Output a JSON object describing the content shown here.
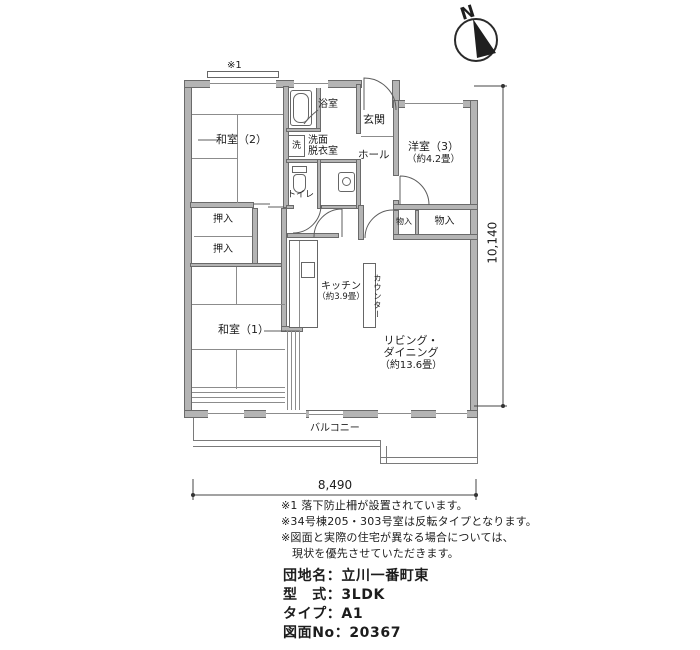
{
  "compass": {
    "label": "N"
  },
  "plan": {
    "mark_note1": "※1",
    "rooms": {
      "washitsu2": "和室（2）",
      "washitsu1": "和室（1）",
      "yoshitsu3": "洋室（3）",
      "yoshitsu3_size": "（約4.2畳）",
      "bath": "浴室",
      "washer": "洗",
      "senmen1": "洗面",
      "senmen2": "脱衣室",
      "toilet": "トイレ",
      "genkan": "玄関",
      "hall": "ホール",
      "oshiire_a": "押入",
      "oshiire_b": "押入",
      "monoire_a": "物入",
      "monoire_b": "物入",
      "kitchen": "キッチン",
      "kitchen_size": "（約3.9畳）",
      "counter": "カウンター",
      "living1": "リビング・",
      "living2": "ダイニング",
      "living_size": "（約13.6畳）",
      "balcony": "バルコニー"
    },
    "dimensions": {
      "width": "8,490",
      "height": "10,140"
    }
  },
  "notes": [
    "※1 落下防止柵が設置されています。",
    "※34号棟205・303号室は反転タイプとなります。",
    "※図面と実際の住宅が異なる場合については、",
    "現状を優先させていただきます。"
  ],
  "property": {
    "lines": [
      "団地名：立川一番町東",
      "型　式：3LDK",
      "タイプ：A1",
      "図面No：20367"
    ]
  },
  "colors": {
    "wall": "#b4b4b4",
    "line": "#5c5c5c",
    "text": "#1c1c1c"
  }
}
